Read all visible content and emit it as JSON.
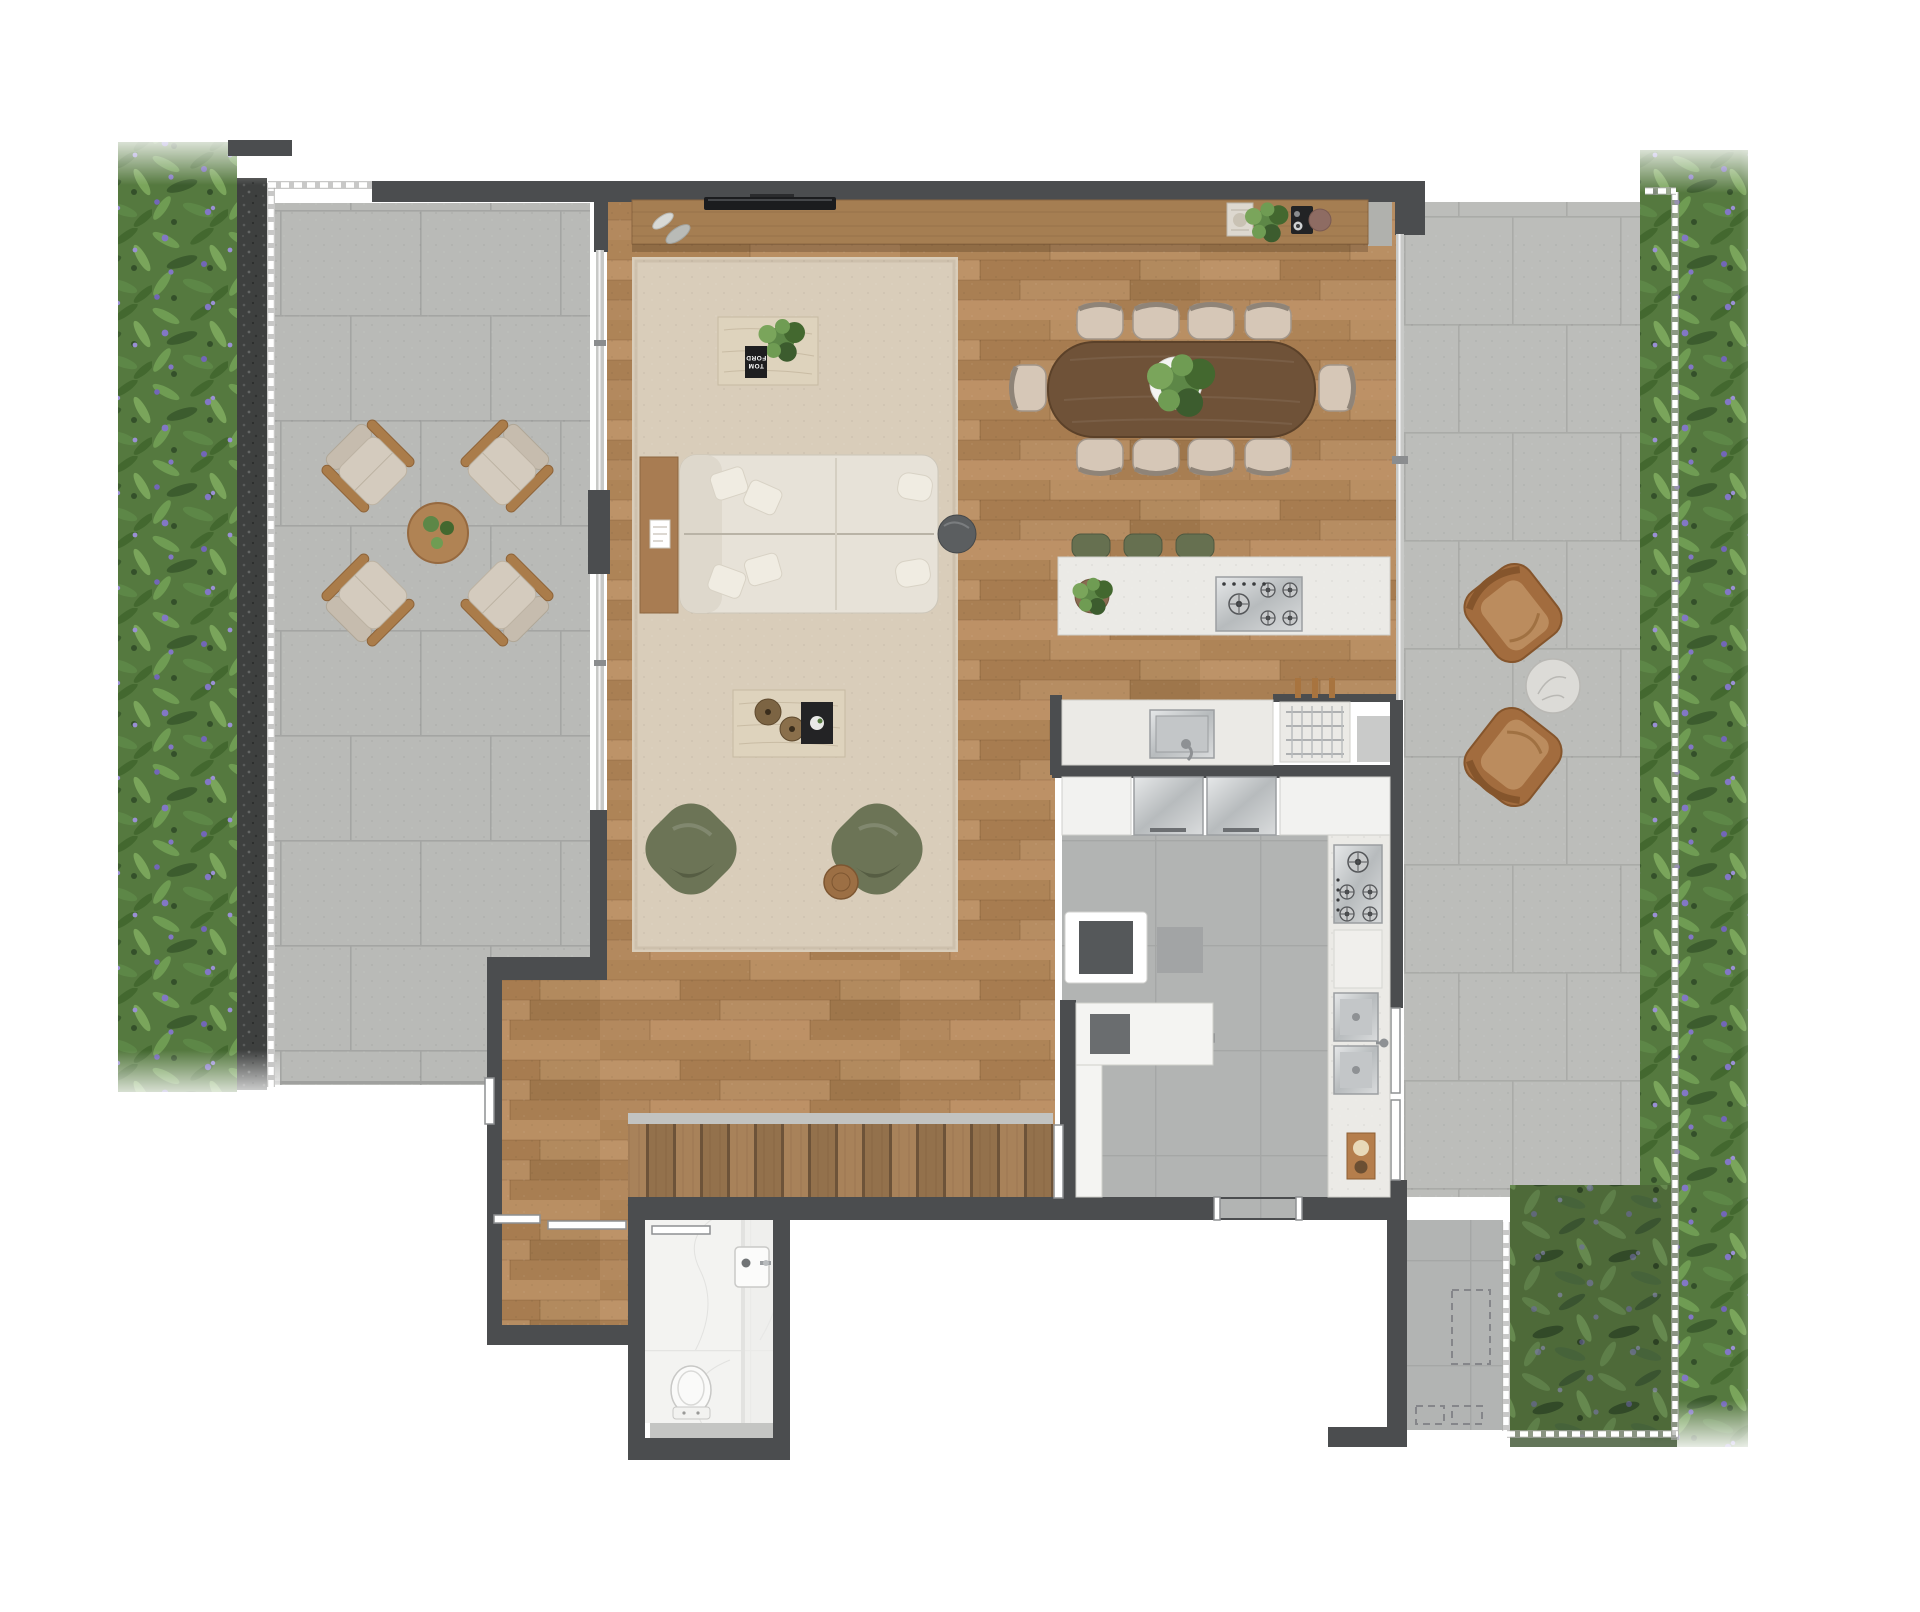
{
  "page": {
    "background": "#ffffff",
    "description": "Top-view architectural floor plan render: living/dining room with wood floor, kitchen, pantry, bathroom, staircase, wrap-around stone terraces and planted garden strips"
  },
  "book": {
    "line1": "TOM",
    "line2": "FORD"
  },
  "colors": {
    "wall": "#4b4d4f",
    "wood_floor": "#b28a5f",
    "console_wood": "#a57e52",
    "stair_wood": "#9a7750",
    "terrace_tile": "#b9bab7",
    "kitchen_tile": "#b2b4b3",
    "grout": "#a4a5a3",
    "rug": "#d9cdba",
    "sofa": "#e7e2d8",
    "cushion": "#f0ece2",
    "pouf": "#6c7456",
    "stool": "#667050",
    "dining_table": "#6f5238",
    "chair_seat": "#d6c7b7",
    "counter": "#ebeae6",
    "steel": "#d6d8d9",
    "marble": "#f3f3f1",
    "travertine": "#ded3bd",
    "gravel": "#3e403f",
    "plant_green": "#55793f",
    "plant_light": "#7aa55b",
    "plant_dark": "#3c5c2e",
    "flower": "#8277c5",
    "grass": "#4e6a39",
    "glass": "#c8c9c7",
    "outdoor_wood": "#aa7c4a",
    "tv_black": "#1b1c1e"
  },
  "areas": {
    "living_room": "wood floor with area rug",
    "dining_area": "oval table, 10 chairs",
    "kitchen": "gray tile, island with gas cooktop",
    "pantry": "service room with counters",
    "bathroom": "marble floor, toilet and basin",
    "stairs": "wood tread staircase",
    "terrace_left": "4 armchairs around round table",
    "terrace_right": "2 lounge chairs with marble side table",
    "garden_strips": "planted beds with purple flowers",
    "grass_patch": "dense shrubs at lower right"
  },
  "furniture_counts": {
    "sofa_seats": 1,
    "coffee_tables": 2,
    "green_poufs": 2,
    "dining_chairs": 10,
    "bar_stools": 3,
    "outdoor_armchairs": 4,
    "outdoor_lounge_chairs": 2,
    "cooktops": 2,
    "sinks": 3
  }
}
